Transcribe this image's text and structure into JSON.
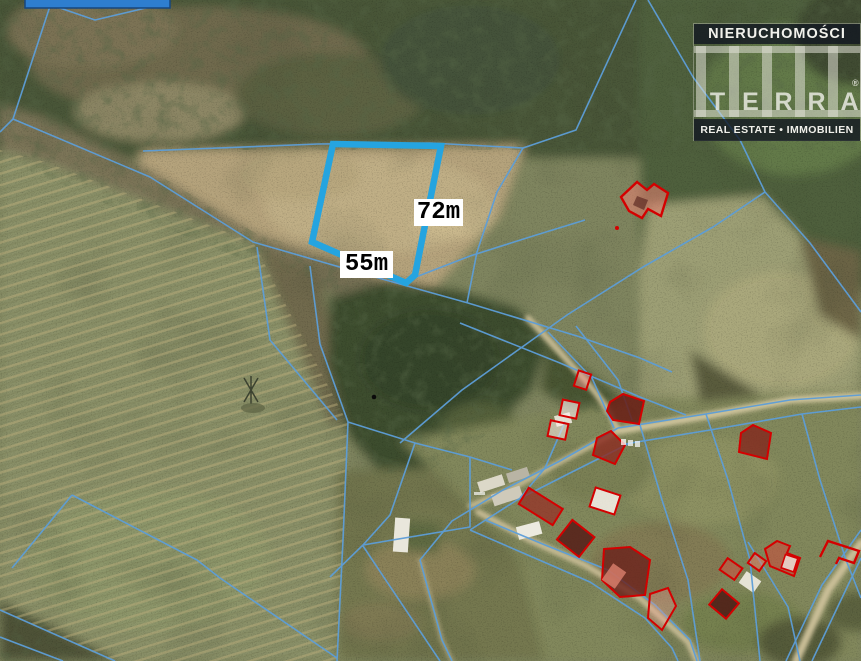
{
  "map": {
    "dimension_labels": {
      "side_long": "72m",
      "side_short": "55m"
    },
    "colors": {
      "parcel_highlight": "#25a4e0",
      "cadastral_line": "#5d9ed8",
      "building_outline": "#d40000",
      "map_tag_blue": "#2e7ecf"
    }
  },
  "watermark": {
    "line1": "NIERUCHOMOŚCI",
    "brand": "TERRA",
    "brand_letters": [
      "T",
      "E",
      "R",
      "R",
      "A"
    ],
    "registered_mark": "®",
    "line3": "REAL ESTATE • IMMOBILIEN"
  }
}
